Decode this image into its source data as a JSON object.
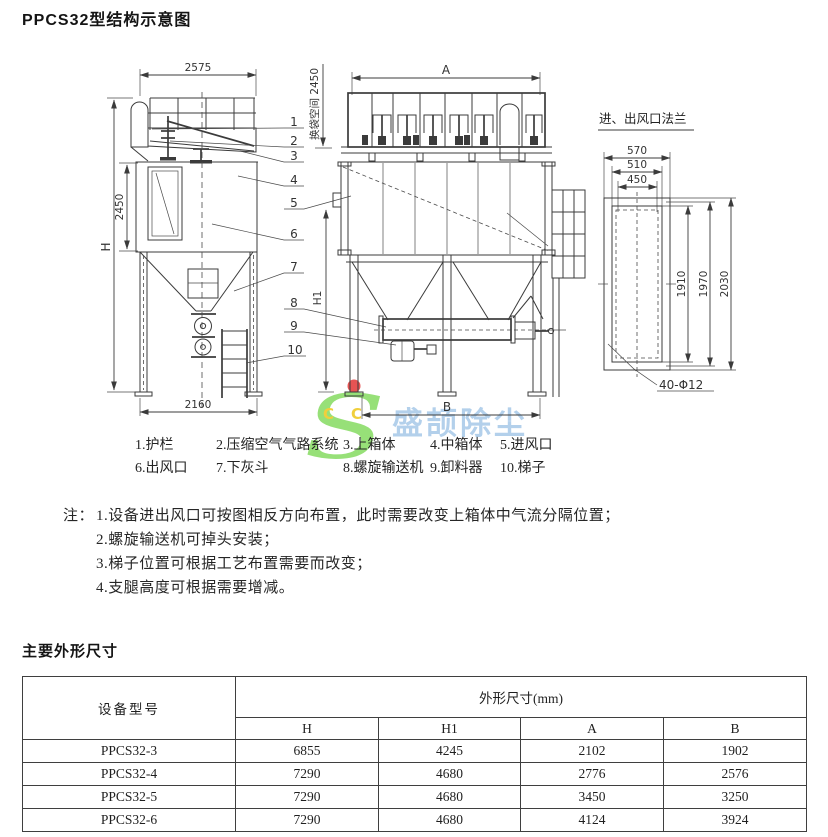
{
  "page": {
    "title": "PPCS32型结构示意图",
    "dimensions_title": "主要外形尺寸"
  },
  "diagram": {
    "left_view": {
      "dim_top_width": "2575",
      "dim_bag_chamber": "2450",
      "dim_height": "H",
      "dim_base": "2160",
      "dim_support_height": "H1",
      "dim_change_space": "换袋空间 2450"
    },
    "front_view": {
      "dim_top_width": "A",
      "dim_bottom_width": "B"
    },
    "flange": {
      "title": "进、出风口法兰",
      "dim_outer": "570",
      "dim_mid": "510",
      "dim_inner": "450",
      "dim_v1": "1910",
      "dim_v2": "1970",
      "dim_v3": "2030",
      "holes": "40-Φ12"
    },
    "callouts": [
      "1",
      "2",
      "3",
      "4",
      "5",
      "6",
      "7",
      "8",
      "9",
      "10"
    ],
    "watermark": {
      "monogram": "S",
      "letters": [
        "C",
        "C"
      ],
      "text": "盛颉除尘"
    }
  },
  "parts": [
    "1.护栏",
    "2.压缩空气气路系统",
    "3.上箱体",
    "4.中箱体",
    "5.进风口",
    "6.出风口",
    "7.下灰斗",
    "8.螺旋输送机",
    "9.卸料器",
    "10.梯子"
  ],
  "notes": {
    "label": "注：",
    "items": [
      "1.设备进出风口可按图相反方向布置，此时需要改变上箱体中气流分隔位置；",
      "2.螺旋输送机可掉头安装；",
      "3.梯子位置可根据工艺布置需要而改变；",
      "4.支腿高度可根据需要增减。"
    ]
  },
  "table": {
    "col_model": "设备型号",
    "col_group": "外形尺寸(mm)",
    "sub_cols": [
      "H",
      "H1",
      "A",
      "B"
    ],
    "rows": [
      {
        "model": "PPCS32-3",
        "h": "6855",
        "h1": "4245",
        "a": "2102",
        "b": "1902"
      },
      {
        "model": "PPCS32-4",
        "h": "7290",
        "h1": "4680",
        "a": "2776",
        "b": "2576"
      },
      {
        "model": "PPCS32-5",
        "h": "7290",
        "h1": "4680",
        "a": "3450",
        "b": "3250"
      },
      {
        "model": "PPCS32-6",
        "h": "7290",
        "h1": "4680",
        "a": "4124",
        "b": "3924"
      }
    ]
  },
  "colors": {
    "line": "#3b3b3b",
    "watermark_green": "#7ed957",
    "watermark_blue": "#85b4e0",
    "accent_red": "#e34040",
    "accent_yellow": "#f0cf3c"
  }
}
